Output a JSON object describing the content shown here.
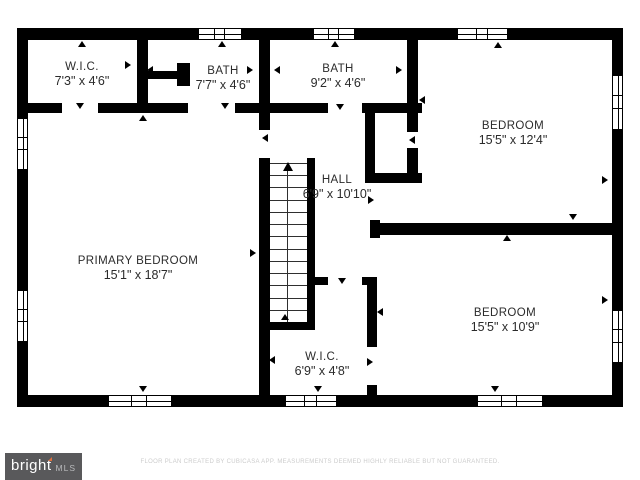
{
  "footer": {
    "disclaimer": "FLOOR PLAN CREATED BY CUBICASA APP. MEASUREMENTS DEEMED HIGHLY RELIABLE BUT NOT GUARANTEED."
  },
  "logo": {
    "brand": "bright",
    "suffix": "MLS"
  },
  "colors": {
    "wall": "#000000",
    "label_text": "#2b2b2b",
    "footer_text": "#cccccc",
    "logo_bg": "#59595b",
    "logo_accent": "#e0703d"
  },
  "rooms": [
    {
      "slug": "wic-top-left",
      "name": "W.I.C.",
      "dims": "7'3\" x 4'6\"",
      "x": 82,
      "y": 60
    },
    {
      "slug": "bath-left",
      "name": "BATH",
      "dims": "7'7\" x 4'6\"",
      "x": 223,
      "y": 64
    },
    {
      "slug": "bath-middle",
      "name": "BATH",
      "dims": "9'2\" x 4'6\"",
      "x": 338,
      "y": 62
    },
    {
      "slug": "bedroom-top-right",
      "name": "BEDROOM",
      "dims": "15'5\" x 12'4\"",
      "x": 513,
      "y": 119
    },
    {
      "slug": "hall",
      "name": "HALL",
      "dims": "6'9\" x 10'10\"",
      "x": 337,
      "y": 173
    },
    {
      "slug": "primary-bedroom",
      "name": "PRIMARY BEDROOM",
      "dims": "15'1\" x 18'7\"",
      "x": 138,
      "y": 254
    },
    {
      "slug": "bedroom-bottom-right",
      "name": "BEDROOM",
      "dims": "15'5\" x 10'9\"",
      "x": 505,
      "y": 306
    },
    {
      "slug": "wic-bottom",
      "name": "W.I.C.",
      "dims": "6'9\" x 4'8\"",
      "x": 322,
      "y": 350
    }
  ],
  "walls": [
    [
      17,
      28,
      606,
      12
    ],
    [
      17,
      395,
      606,
      12
    ],
    [
      17,
      28,
      11,
      379
    ],
    [
      612,
      28,
      11,
      379
    ],
    [
      137,
      40,
      11,
      73
    ],
    [
      259,
      40,
      11,
      90
    ],
    [
      259,
      158,
      11,
      239
    ],
    [
      407,
      40,
      11,
      92
    ],
    [
      28,
      103,
      34,
      10
    ],
    [
      98,
      103,
      90,
      10
    ],
    [
      235,
      103,
      35,
      10
    ],
    [
      270,
      103,
      58,
      10
    ],
    [
      362,
      103,
      60,
      10
    ],
    [
      365,
      103,
      10,
      80
    ],
    [
      365,
      173,
      57,
      10
    ],
    [
      407,
      148,
      11,
      35
    ],
    [
      307,
      158,
      8,
      172
    ],
    [
      259,
      322,
      56,
      8
    ],
    [
      315,
      277,
      13,
      8
    ],
    [
      362,
      277,
      15,
      8
    ],
    [
      367,
      277,
      10,
      70
    ],
    [
      367,
      385,
      10,
      12
    ],
    [
      370,
      223,
      243,
      12
    ],
    [
      370,
      220,
      10,
      18
    ],
    [
      148,
      71,
      32,
      8
    ],
    [
      177,
      63,
      13,
      23
    ]
  ],
  "windows": [
    [
      198,
      28,
      44,
      12
    ],
    [
      313,
      28,
      42,
      12
    ],
    [
      457,
      28,
      51,
      12
    ],
    [
      108,
      395,
      64,
      12
    ],
    [
      285,
      395,
      52,
      12
    ],
    [
      477,
      395,
      66,
      12
    ],
    [
      17,
      118,
      11,
      52
    ],
    [
      17,
      290,
      11,
      52
    ],
    [
      612,
      75,
      11,
      55
    ],
    [
      612,
      310,
      11,
      53
    ]
  ],
  "stairs": {
    "x": 270,
    "y": 158,
    "w": 37,
    "h": 164,
    "treads": 13,
    "center_x": 287,
    "arrow_y": 162
  },
  "arrows": [
    [
      82,
      44,
      "up"
    ],
    [
      22,
      65,
      "left"
    ],
    [
      128,
      65,
      "right"
    ],
    [
      80,
      106,
      "down"
    ],
    [
      222,
      44,
      "up"
    ],
    [
      150,
      70,
      "left"
    ],
    [
      250,
      70,
      "right"
    ],
    [
      225,
      106,
      "down"
    ],
    [
      335,
      44,
      "up"
    ],
    [
      277,
      70,
      "left"
    ],
    [
      399,
      70,
      "right"
    ],
    [
      340,
      107,
      "down"
    ],
    [
      498,
      45,
      "up"
    ],
    [
      422,
      100,
      "left"
    ],
    [
      605,
      180,
      "right"
    ],
    [
      573,
      217,
      "down"
    ],
    [
      265,
      138,
      "left"
    ],
    [
      412,
      140,
      "left"
    ],
    [
      143,
      118,
      "up"
    ],
    [
      23,
      253,
      "left"
    ],
    [
      253,
      253,
      "right"
    ],
    [
      143,
      389,
      "down"
    ],
    [
      371,
      200,
      "right"
    ],
    [
      507,
      238,
      "up"
    ],
    [
      605,
      300,
      "right"
    ],
    [
      495,
      389,
      "down"
    ],
    [
      380,
      312,
      "left"
    ],
    [
      342,
      281,
      "down"
    ],
    [
      370,
      362,
      "right"
    ],
    [
      285,
      317,
      "up"
    ],
    [
      318,
      389,
      "down"
    ],
    [
      272,
      360,
      "left"
    ]
  ]
}
